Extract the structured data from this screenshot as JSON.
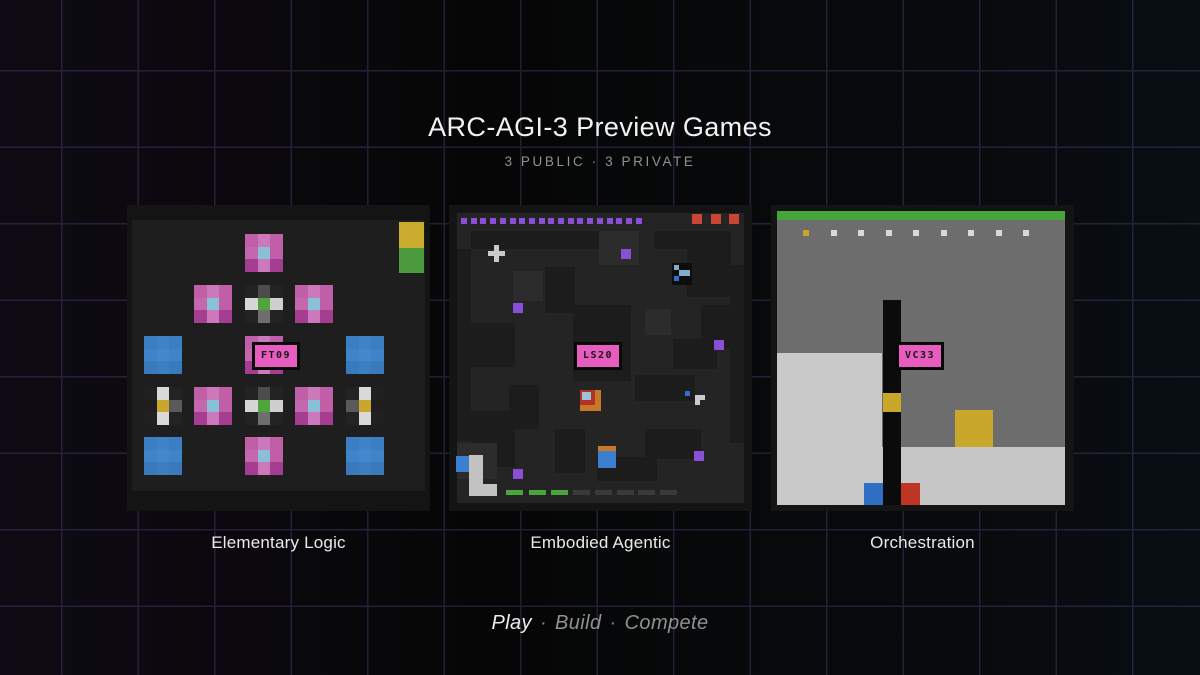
{
  "header": {
    "title": "ARC-AGI-3 Preview Games",
    "subtitle": "3 PUBLIC · 3 PRIVATE"
  },
  "footer": {
    "separator": "·",
    "items": [
      {
        "text": "Play",
        "emphasis": true
      },
      {
        "text": "Build",
        "emphasis": false
      },
      {
        "text": "Compete",
        "emphasis": false
      }
    ]
  },
  "colors": {
    "background": "#060606",
    "grid_line": "#241e32",
    "badge_pink": "#e75dbf",
    "accent_purple": "#8a4fd6",
    "accent_green": "#49a53c",
    "accent_yellow": "#c9a72b",
    "accent_blue": "#3a7fd0",
    "accent_red": "#ca4534"
  },
  "cards": [
    {
      "title": "Elementary Logic",
      "code": "FT09",
      "board": {
        "palettes": {
          "pink": [
            [
              "#c05fa8",
              "#cc79bb",
              "#c05fa8"
            ],
            [
              "#c468ad",
              "#8abfd8",
              "#c05fa8"
            ],
            [
              "#a53e90",
              "#cc79bb",
              "#a53e90"
            ]
          ],
          "cross": [
            [
              "#232323",
              "#4c4c4c",
              "#232323"
            ],
            [
              "#d6d6d6",
              "#4fa53c",
              "#cfcfcf"
            ],
            [
              "#232323",
              "#6e6e6e",
              "#232323"
            ]
          ],
          "blue": [
            [
              "#3c7ec2",
              "#4083c9",
              "#3c7ec2"
            ],
            [
              "#4083c9",
              "#4487cd",
              "#4083c9"
            ],
            [
              "#3a79bb",
              "#3c7ec2",
              "#3a79bb"
            ]
          ],
          "gyr": [
            [
              "#202020",
              "#d9d9d9",
              "#232323"
            ],
            [
              "#1e1e1e",
              "#c9a72b",
              "#5a5a5a"
            ],
            [
              "#202020",
              "#d9d9d9",
              "#232323"
            ]
          ],
          "gyl": [
            [
              "#232323",
              "#d9d9d9",
              "#202020"
            ],
            [
              "#5a5a5a",
              "#c9a72b",
              "#1e1e1e"
            ],
            [
              "#232323",
              "#d9d9d9",
              "#202020"
            ]
          ]
        },
        "elements": [
          {
            "type": "rect",
            "name": "board-interior",
            "x": 5,
            "y": 15,
            "w": 293,
            "h": 271,
            "color": "#1e1e1e",
            "grid": true
          },
          {
            "type": "rect",
            "name": "stack-block-yellow",
            "x": 272,
            "y": 17,
            "w": 25,
            "h": 26,
            "color": "#c9ab2e"
          },
          {
            "type": "rect",
            "name": "stack-block-green",
            "x": 272,
            "y": 43,
            "w": 25,
            "h": 25,
            "color": "#4b9a3e"
          },
          {
            "type": "mosaic",
            "name": "flower-tile",
            "x": 118,
            "y": 29,
            "w": 38,
            "h": 38,
            "cells_ref": "pink"
          },
          {
            "type": "mosaic",
            "name": "flower-tile",
            "x": 67,
            "y": 80,
            "w": 38,
            "h": 38,
            "cells_ref": "pink"
          },
          {
            "type": "mosaic",
            "name": "cross-tile",
            "x": 118,
            "y": 80,
            "w": 38,
            "h": 38,
            "cells_ref": "cross"
          },
          {
            "type": "mosaic",
            "name": "flower-tile",
            "x": 168,
            "y": 80,
            "w": 38,
            "h": 38,
            "cells_ref": "pink"
          },
          {
            "type": "mosaic",
            "name": "blue-tile",
            "x": 17,
            "y": 131,
            "w": 38,
            "h": 38,
            "cells_ref": "blue"
          },
          {
            "type": "mosaic",
            "name": "flower-tile",
            "x": 118,
            "y": 131,
            "w": 38,
            "h": 38,
            "cells_ref": "pink"
          },
          {
            "type": "mosaic",
            "name": "blue-tile",
            "x": 219,
            "y": 131,
            "w": 38,
            "h": 38,
            "cells_ref": "blue"
          },
          {
            "type": "mosaic",
            "name": "yellow-key-tile",
            "x": 17,
            "y": 182,
            "w": 38,
            "h": 38,
            "cells_ref": "gyr"
          },
          {
            "type": "mosaic",
            "name": "flower-tile",
            "x": 67,
            "y": 182,
            "w": 38,
            "h": 38,
            "cells_ref": "pink"
          },
          {
            "type": "mosaic",
            "name": "cross-tile",
            "x": 118,
            "y": 182,
            "w": 38,
            "h": 38,
            "cells_ref": "cross"
          },
          {
            "type": "mosaic",
            "name": "flower-tile",
            "x": 168,
            "y": 182,
            "w": 38,
            "h": 38,
            "cells_ref": "pink"
          },
          {
            "type": "mosaic",
            "name": "yellow-key-tile",
            "x": 219,
            "y": 182,
            "w": 38,
            "h": 38,
            "cells_ref": "gyl"
          },
          {
            "type": "mosaic",
            "name": "blue-tile",
            "x": 17,
            "y": 232,
            "w": 38,
            "h": 38,
            "cells_ref": "blue"
          },
          {
            "type": "mosaic",
            "name": "flower-tile",
            "x": 118,
            "y": 232,
            "w": 38,
            "h": 38,
            "cells_ref": "pink"
          },
          {
            "type": "mosaic",
            "name": "blue-tile",
            "x": 219,
            "y": 232,
            "w": 38,
            "h": 38,
            "cells_ref": "blue"
          }
        ]
      }
    },
    {
      "title": "Embodied Agentic",
      "code": "LS20",
      "board": {
        "palettes": {},
        "elements": [
          {
            "type": "rect",
            "name": "dungeon-floor",
            "x": 8,
            "y": 8,
            "w": 287,
            "h": 290,
            "color": "#242424"
          },
          {
            "type": "rect",
            "name": "wall-patch",
            "x": 22,
            "y": 26,
            "w": 128,
            "h": 18,
            "color": "#1c1c1c"
          },
          {
            "type": "rect",
            "name": "wall-patch",
            "x": 205,
            "y": 26,
            "w": 72,
            "h": 18,
            "color": "#1c1c1c"
          },
          {
            "type": "rect",
            "name": "wall-patch",
            "x": 8,
            "y": 44,
            "w": 14,
            "h": 192,
            "color": "#1c1c1c"
          },
          {
            "type": "rect",
            "name": "wall-patch",
            "x": 22,
            "y": 118,
            "w": 44,
            "h": 44,
            "color": "#1c1c1c"
          },
          {
            "type": "rect",
            "name": "wall-patch",
            "x": 96,
            "y": 62,
            "w": 30,
            "h": 46,
            "color": "#1c1c1c"
          },
          {
            "type": "rect",
            "name": "wall-patch",
            "x": 124,
            "y": 100,
            "w": 58,
            "h": 76,
            "color": "#1c1c1c"
          },
          {
            "type": "rect",
            "name": "wall-patch",
            "x": 238,
            "y": 26,
            "w": 44,
            "h": 66,
            "color": "#1c1c1c"
          },
          {
            "type": "rect",
            "name": "wall-patch",
            "x": 252,
            "y": 100,
            "w": 30,
            "h": 44,
            "color": "#1c1c1c"
          },
          {
            "type": "rect",
            "name": "wall-patch",
            "x": 224,
            "y": 134,
            "w": 44,
            "h": 30,
            "color": "#1c1c1c"
          },
          {
            "type": "rect",
            "name": "wall-patch",
            "x": 186,
            "y": 170,
            "w": 60,
            "h": 26,
            "color": "#1c1c1c"
          },
          {
            "type": "rect",
            "name": "wall-patch",
            "x": 60,
            "y": 180,
            "w": 30,
            "h": 44,
            "color": "#1c1c1c"
          },
          {
            "type": "rect",
            "name": "wall-patch",
            "x": 22,
            "y": 206,
            "w": 44,
            "h": 56,
            "color": "#1c1c1c"
          },
          {
            "type": "rect",
            "name": "wall-patch",
            "x": 106,
            "y": 224,
            "w": 30,
            "h": 44,
            "color": "#1c1c1c"
          },
          {
            "type": "rect",
            "name": "wall-patch",
            "x": 196,
            "y": 224,
            "w": 56,
            "h": 30,
            "color": "#1c1c1c"
          },
          {
            "type": "rect",
            "name": "wall-patch",
            "x": 281,
            "y": 60,
            "w": 14,
            "h": 178,
            "color": "#1c1c1c"
          },
          {
            "type": "rect",
            "name": "wall-patch",
            "x": 148,
            "y": 252,
            "w": 60,
            "h": 24,
            "color": "#1c1c1c"
          },
          {
            "type": "rect",
            "name": "floor-highlight",
            "x": 150,
            "y": 26,
            "w": 40,
            "h": 34,
            "color": "#2c2c2c"
          },
          {
            "type": "rect",
            "name": "floor-highlight",
            "x": 64,
            "y": 66,
            "w": 30,
            "h": 30,
            "color": "#2c2c2c"
          },
          {
            "type": "rect",
            "name": "floor-highlight",
            "x": 196,
            "y": 104,
            "w": 26,
            "h": 26,
            "color": "#2c2c2c"
          },
          {
            "type": "rect",
            "name": "floor-highlight",
            "x": 8,
            "y": 238,
            "w": 40,
            "h": 36,
            "color": "#2c2c2c"
          },
          {
            "type": "dotrow",
            "name": "energy-dot",
            "x": 12,
            "y": 13,
            "w": 6,
            "h": 6,
            "pitch": 9.7,
            "count": 19,
            "color": "#8a4fd6"
          },
          {
            "type": "dotrow",
            "name": "life-square",
            "x": 243,
            "y": 9,
            "w": 10,
            "h": 10,
            "pitch": 18.5,
            "count": 3,
            "color": "#ca4534"
          },
          {
            "type": "mosaic",
            "name": "plus-pickup",
            "x": 39,
            "y": 40,
            "w": 17,
            "h": 17,
            "cells": [
              [
                null,
                "#c9c9c9",
                null
              ],
              [
                "#c9c9c9",
                "#c9c9c9",
                "#c9c9c9"
              ],
              [
                null,
                "#c9c9c9",
                null
              ]
            ]
          },
          {
            "type": "rect",
            "name": "purple-pickup",
            "x": 172,
            "y": 44,
            "w": 10,
            "h": 10,
            "color": "#8a4fd6"
          },
          {
            "type": "rect",
            "name": "purple-pickup",
            "x": 64,
            "y": 98,
            "w": 10,
            "h": 10,
            "color": "#8a4fd6"
          },
          {
            "type": "rect",
            "name": "purple-pickup",
            "x": 265,
            "y": 135,
            "w": 10,
            "h": 10,
            "color": "#8a4fd6"
          },
          {
            "type": "rect",
            "name": "purple-pickup",
            "x": 64,
            "y": 264,
            "w": 10,
            "h": 10,
            "color": "#8a4fd6"
          },
          {
            "type": "rect",
            "name": "purple-pickup",
            "x": 245,
            "y": 246,
            "w": 10,
            "h": 10,
            "color": "#8a4fd6"
          },
          {
            "type": "rect",
            "name": "cyan-glyph-cell",
            "x": 223,
            "y": 58,
            "w": 20,
            "h": 22,
            "color": "#0d0d0d"
          },
          {
            "type": "mosaic",
            "name": "cyan-glyph",
            "x": 225,
            "y": 60,
            "w": 16,
            "h": 16,
            "cells": [
              [
                "#82aac9",
                null,
                null
              ],
              [
                null,
                "#82aac9",
                "#82aac9"
              ],
              [
                "#2f6fd0",
                null,
                null
              ]
            ]
          },
          {
            "type": "rect",
            "name": "layered-chest-orange",
            "x": 131,
            "y": 185,
            "w": 21,
            "h": 21,
            "color": "#c87828"
          },
          {
            "type": "rect",
            "name": "layered-chest-red",
            "x": 131,
            "y": 185,
            "w": 15,
            "h": 15,
            "color": "#b13226"
          },
          {
            "type": "rect",
            "name": "layered-chest-blue",
            "x": 133,
            "y": 187,
            "w": 9,
            "h": 8,
            "color": "#9cc3dc"
          },
          {
            "type": "rect",
            "name": "blue-dot",
            "x": 236,
            "y": 186,
            "w": 5,
            "h": 5,
            "color": "#2f6fd0"
          },
          {
            "type": "mosaic",
            "name": "white-corner-glyph",
            "x": 241,
            "y": 190,
            "w": 15,
            "h": 15,
            "cells": [
              [
                null,
                "#cccccc",
                "#cccccc"
              ],
              [
                null,
                "#cccccc",
                null
              ],
              [
                null,
                null,
                null
              ]
            ]
          },
          {
            "type": "rect",
            "name": "player-blue",
            "x": 7,
            "y": 251,
            "w": 14,
            "h": 16,
            "color": "#3a7fd0"
          },
          {
            "type": "rect",
            "name": "white-l-vertical",
            "x": 20,
            "y": 250,
            "w": 14,
            "h": 29,
            "color": "#c2c2c2"
          },
          {
            "type": "rect",
            "name": "white-l-foot",
            "x": 20,
            "y": 279,
            "w": 28,
            "h": 12,
            "color": "#c2c2c2"
          },
          {
            "type": "rect",
            "name": "crate-top-orange",
            "x": 149,
            "y": 241,
            "w": 18,
            "h": 5,
            "color": "#c87828"
          },
          {
            "type": "rect",
            "name": "crate-blue",
            "x": 149,
            "y": 246,
            "w": 18,
            "h": 17,
            "color": "#3a7fd0"
          },
          {
            "type": "dotrow",
            "name": "progress-dash-filled",
            "x": 57,
            "y": 285,
            "w": 17,
            "h": 5,
            "pitch": 22.5,
            "count": 3,
            "color": "#49a53c"
          },
          {
            "type": "dotrow",
            "name": "progress-dash-empty",
            "x": 124,
            "y": 285,
            "w": 17,
            "h": 5,
            "pitch": 21.8,
            "count": 5,
            "color": "#3a3a3a"
          }
        ]
      }
    },
    {
      "title": "Orchestration",
      "code": "VC33",
      "board": {
        "palettes": {},
        "elements": [
          {
            "type": "rect",
            "name": "sky-background",
            "x": 6,
            "y": 6,
            "w": 288,
            "h": 294,
            "color": "#6d6d6d"
          },
          {
            "type": "rect",
            "name": "top-green-bar",
            "x": 6,
            "y": 6,
            "w": 288,
            "h": 9,
            "color": "#45a53b"
          },
          {
            "type": "dotrow",
            "name": "status-dot",
            "x": 32,
            "y": 25,
            "w": 6,
            "h": 6,
            "pitch": 27.5,
            "count": 9,
            "color": "#d9d9d9",
            "overrides": {
              "0": "#c9a72b"
            }
          },
          {
            "type": "rect",
            "name": "left-platform",
            "x": 6,
            "y": 148,
            "w": 105,
            "h": 152,
            "color": "#c9c9c9"
          },
          {
            "type": "rect",
            "name": "ground-strip",
            "x": 111,
            "y": 242,
            "w": 183,
            "h": 58,
            "color": "#c6c6c6"
          },
          {
            "type": "rect",
            "name": "black-column",
            "x": 112,
            "y": 95,
            "w": 18,
            "h": 205,
            "color": "#0b0b0b"
          },
          {
            "type": "rect",
            "name": "yellow-on-column",
            "x": 112,
            "y": 188,
            "w": 18,
            "h": 19,
            "color": "#c9a72b"
          },
          {
            "type": "rect",
            "name": "yellow-crate",
            "x": 184,
            "y": 205,
            "w": 38,
            "h": 37,
            "color": "#c9a72b"
          },
          {
            "type": "rect",
            "name": "blue-block",
            "x": 93,
            "y": 278,
            "w": 19,
            "h": 22,
            "color": "#2e6fc3"
          },
          {
            "type": "rect",
            "name": "red-block",
            "x": 130,
            "y": 278,
            "w": 19,
            "h": 22,
            "color": "#bf3525"
          }
        ]
      }
    }
  ]
}
